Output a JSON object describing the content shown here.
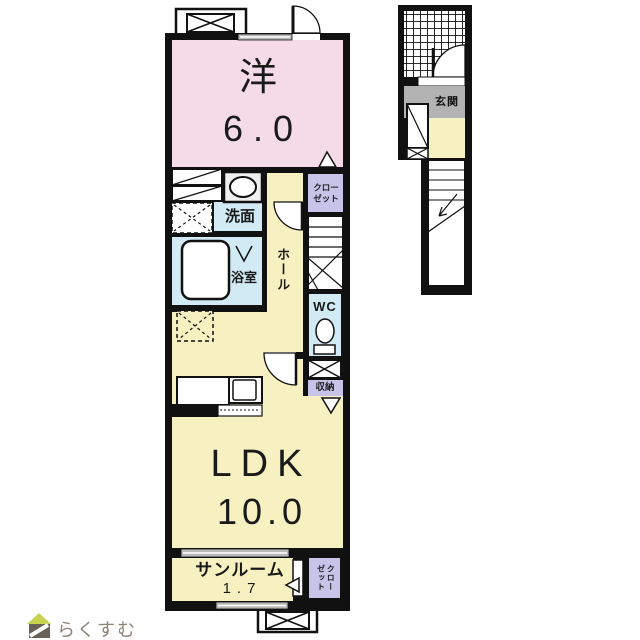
{
  "floorplan": {
    "second_floor": {
      "western_room": {
        "label": "洋",
        "area": "6.0"
      },
      "washroom": {
        "label": "洗面"
      },
      "bathroom": {
        "label": "浴室"
      },
      "hall": {
        "label": "ホール"
      },
      "closet": {
        "label_line1": "クロー",
        "label_line2": "ゼット"
      },
      "wc": {
        "label": "WC"
      },
      "storage": {
        "label": "収納"
      },
      "ldk": {
        "label": "LDK",
        "area": "10.0"
      },
      "sunroom": {
        "label": "サンルーム",
        "area": "1.7"
      },
      "sunroom_closet": {
        "label_col1": "クロー",
        "label_col2": "ゼット"
      }
    },
    "first_floor": {
      "entrance": {
        "label": "玄関"
      }
    },
    "colors": {
      "room_pink": "#f5dbe8",
      "room_yellow": "#f7f1c1",
      "room_blue": "#d2eaf3",
      "room_purple": "#c7c3e9",
      "entrance_gray": "#b3b3b3",
      "wall": "#111111",
      "window_gray": "#b8b8b8",
      "logo_roof_green": "#c8d34f",
      "logo_body_brown": "#6a6156",
      "logo_text_gray": "#8e8378"
    }
  },
  "logo": {
    "text": "らくすむ"
  }
}
